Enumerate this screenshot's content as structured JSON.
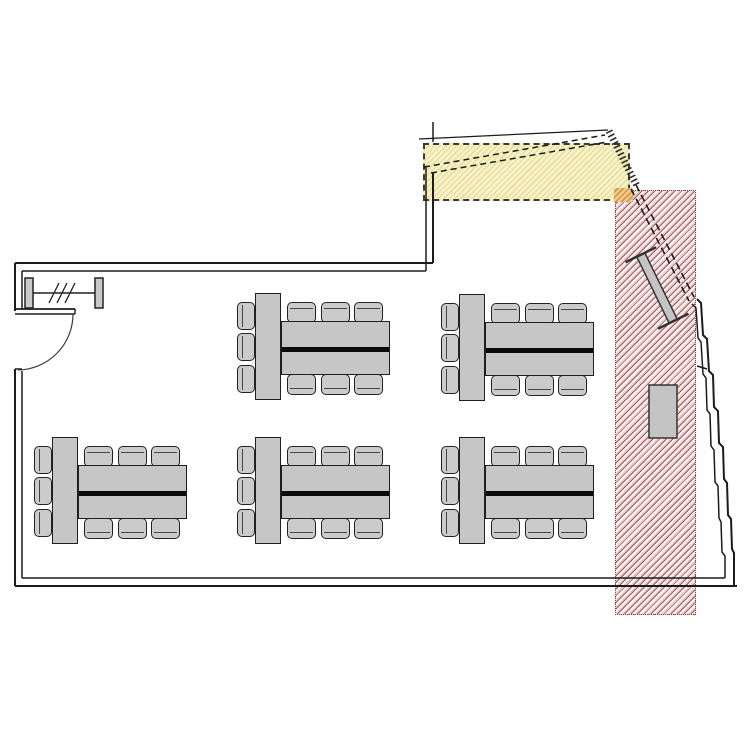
{
  "meta": {
    "drawing_type": "architectural-floor-plan",
    "description": "Classroom floor plan with five table groups, entrance door, yellow dashed alteration zone and red hatched demolition zone"
  },
  "palette": {
    "wall": "#1c1c1c",
    "furniture_fill": "#c6c6c6",
    "furniture_edge": "#1f1f1f",
    "table_divider": "#0a0a0a",
    "yellow_zone_bg": "#f8f3cf",
    "yellow_zone_stripe": "#e9df96",
    "yellow_zone_border": "#3a3a3a",
    "red_zone_bg": "#fefbfb",
    "red_zone_stripe_light": "#edcccc",
    "red_zone_stripe_dark": "#a25454",
    "red_zone_border": "#8a4444",
    "orange_marker_light": "#f5cf96",
    "orange_marker_dark": "#db9a4e"
  },
  "zones": {
    "yellow": {
      "x": 423,
      "y": 143,
      "w": 207,
      "h": 58
    },
    "red": {
      "x": 615,
      "y": 190,
      "w": 81,
      "h": 425
    },
    "orange": {
      "x": 614,
      "y": 188,
      "w": 19,
      "h": 14
    }
  },
  "furniture": {
    "table_groups": [
      {
        "x": 237,
        "y": 293
      },
      {
        "x": 441,
        "y": 294
      },
      {
        "x": 34,
        "y": 437
      },
      {
        "x": 237,
        "y": 437
      },
      {
        "x": 441,
        "y": 437
      }
    ],
    "chairs_per_group": 9,
    "cabinet": {
      "x": 649,
      "y": 385,
      "w": 28,
      "h": 53
    },
    "bench": {
      "cx": 657,
      "cy": 288,
      "angle": -26,
      "length": 74,
      "width": 9,
      "cap": 34
    }
  },
  "door": {
    "hinge_x": 17,
    "hinge_y": 313,
    "radius": 56
  }
}
